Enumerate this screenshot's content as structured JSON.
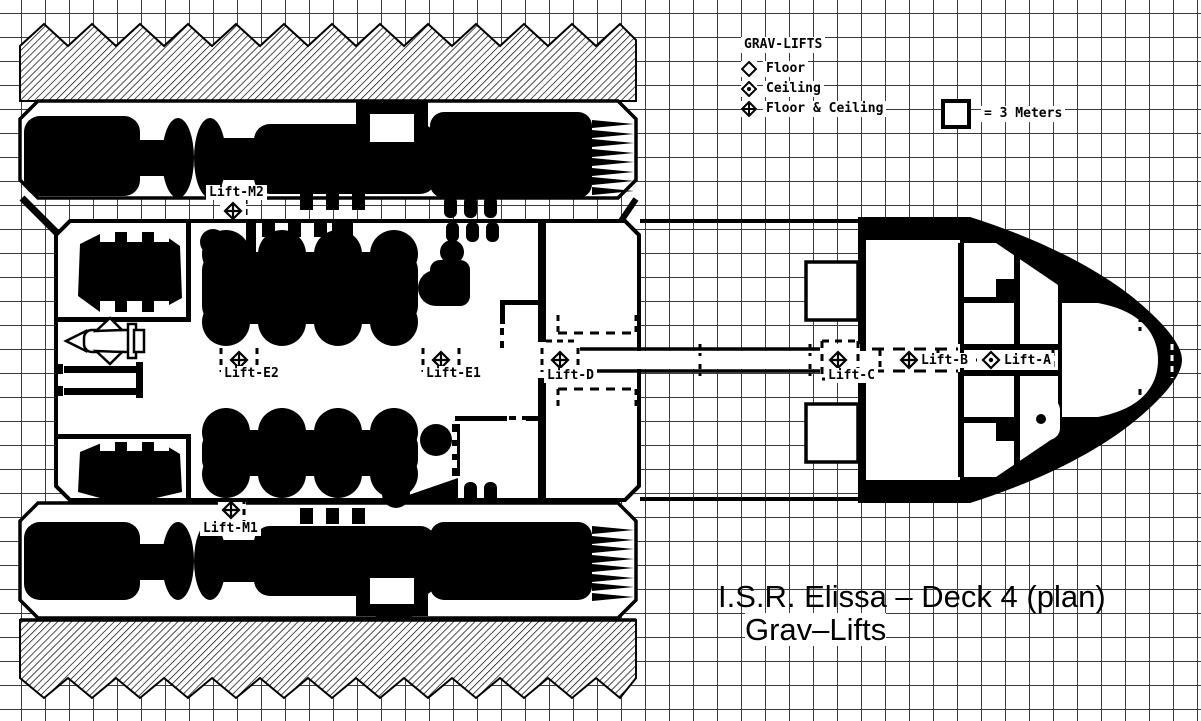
{
  "document": {
    "title_line1": "I.S.R. Elissa – Deck 4 (plan)",
    "title_line2": "Grav–Lifts"
  },
  "legend": {
    "title": "GRAV-LIFTS",
    "items": [
      {
        "symbol": "floor",
        "label": "Floor"
      },
      {
        "symbol": "ceiling",
        "label": "Ceiling"
      },
      {
        "symbol": "floor_ceiling",
        "label": "Floor & Ceiling"
      }
    ]
  },
  "scale": {
    "label": "= 3 Meters"
  },
  "lifts": [
    {
      "id": "lift-m2",
      "label": "Lift-M2",
      "symbol": "floor_ceiling"
    },
    {
      "id": "lift-e2",
      "label": "Lift-E2",
      "symbol": "floor_ceiling"
    },
    {
      "id": "lift-e1",
      "label": "Lift-E1",
      "symbol": "floor_ceiling"
    },
    {
      "id": "lift-d",
      "label": "Lift-D",
      "symbol": "floor_ceiling"
    },
    {
      "id": "lift-c",
      "label": "Lift-C",
      "symbol": "floor_ceiling"
    },
    {
      "id": "lift-b",
      "label": "Lift-B",
      "symbol": "floor_ceiling"
    },
    {
      "id": "lift-a",
      "label": "Lift-A",
      "symbol": "ceiling"
    },
    {
      "id": "lift-m1",
      "label": "Lift-M1",
      "symbol": "floor_ceiling"
    }
  ],
  "colors": {
    "grid": "#2a2ad2",
    "ink": "#000000",
    "paper": "#ffffff"
  }
}
